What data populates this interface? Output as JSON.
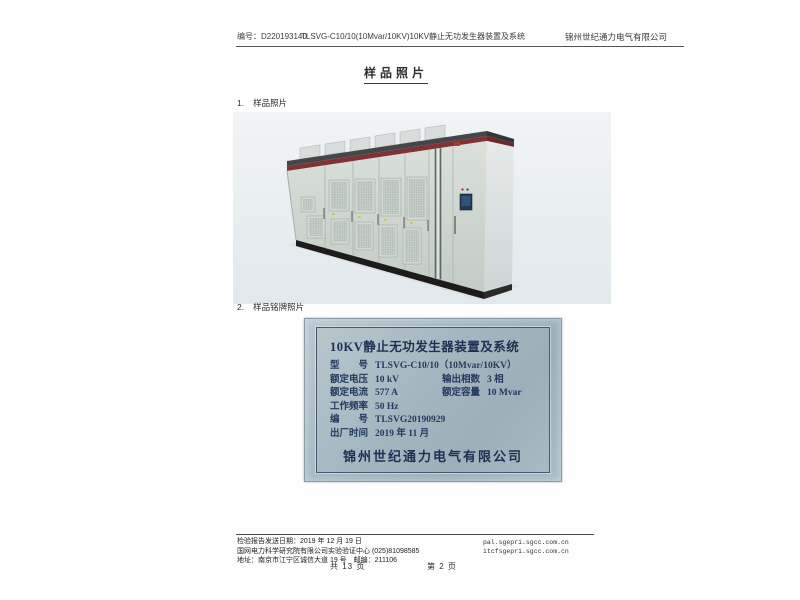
{
  "header": {
    "doc_no": "编号：D220193140",
    "title": "TLSVG-C10/10(10Mvar/10KV)10KV静止无功发生器装置及系统",
    "company": "锦州世纪通力电气有限公司"
  },
  "page_title": "样品照片",
  "section1": {
    "no": "1.",
    "title": "样品照片"
  },
  "section2": {
    "no": "2.",
    "title": "样品铭牌照片"
  },
  "nameplate": {
    "title": "10KV静止无功发生器装置及系统",
    "model_label": "型　　号",
    "model_value": "TLSVG-C10/10（10Mvar/10KV）",
    "voltage_label": "额定电压",
    "voltage_value": "10 kV",
    "phase_label": "输出相数",
    "phase_value": "3 相",
    "current_label": "额定电流",
    "current_value": "577 A",
    "capacity_label": "额定容量",
    "capacity_value": "10 Mvar",
    "freq_label": "工作频率",
    "freq_value": "50 Hz",
    "serial_label": "编　　号",
    "serial_value": "TLSVG20190929",
    "date_label": "出厂时间",
    "date_value": "2019 年 11 月",
    "company": "锦州世纪通力电气有限公司"
  },
  "footer": {
    "send_date": "检验报告发送日期：2019 年 12 月 19 日",
    "org": "国网电力科学研究院有限公司实验验证中心 (025)81098585",
    "address": "地址：南京市江宁区诚信大道 19 号　邮编：211106",
    "url1": "pal.sgepri.sgcc.com.cn",
    "url2": "itcfsgepri.sgcc.com.cn",
    "pages_total": "共  13  页",
    "page_current": "第  2  页"
  },
  "colors": {
    "plate_background": "#a9bcc4",
    "plate_text": "#1d3050",
    "cabinet_stripe_red": "#7e3434",
    "cabinet_body": "#ccd4ce"
  }
}
